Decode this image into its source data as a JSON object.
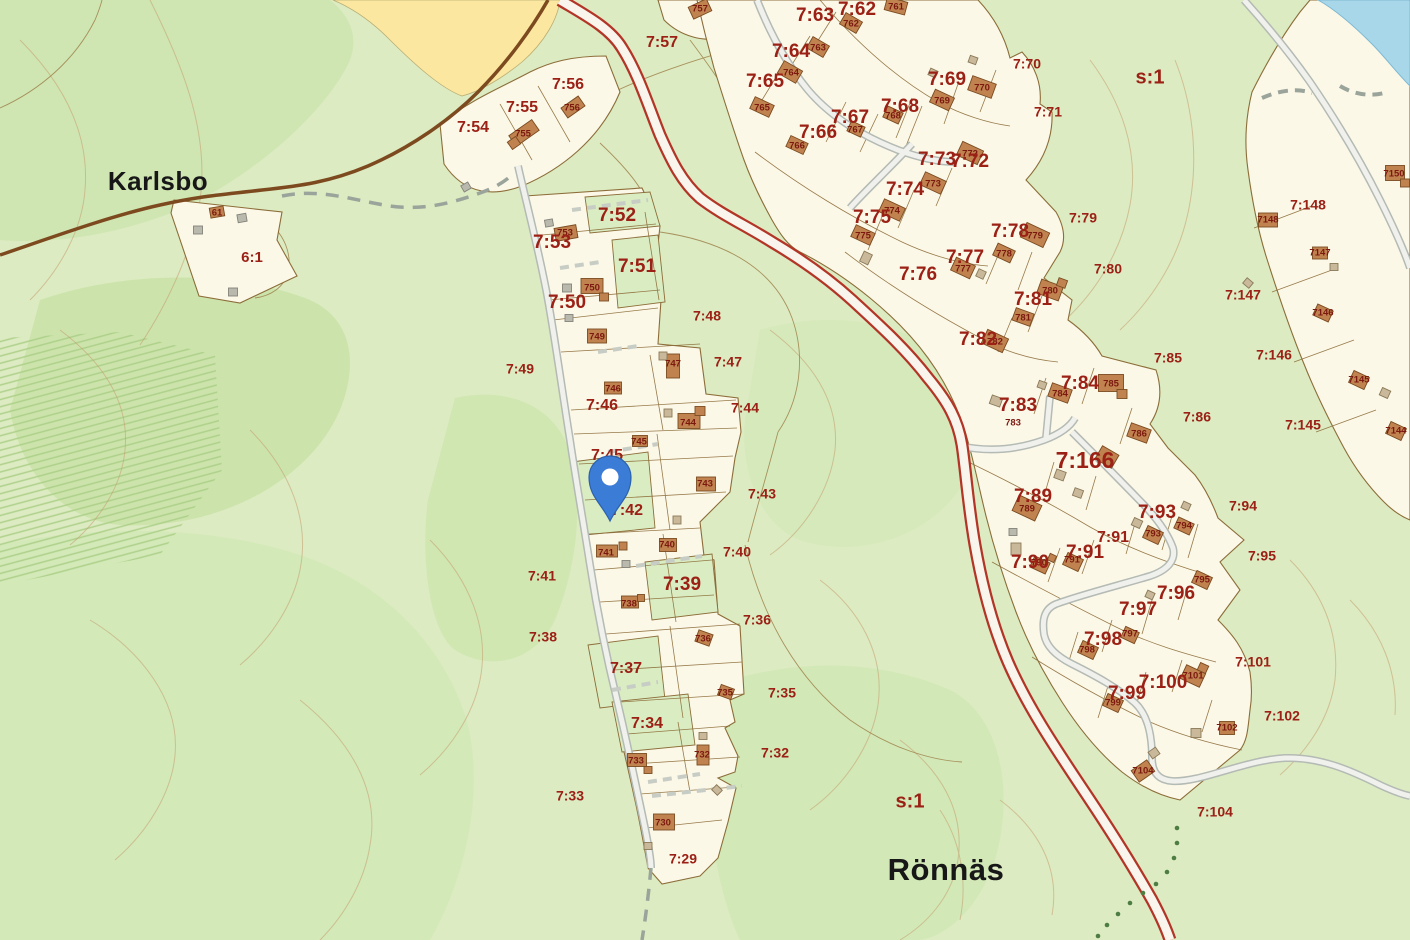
{
  "map": {
    "place_labels": [
      {
        "text": "Karlsbo",
        "x": 158,
        "y": 183,
        "size": 26
      },
      {
        "text": "Rönnäs",
        "x": 946,
        "y": 872,
        "size": 31
      }
    ],
    "area_labels": [
      {
        "text": "s:1",
        "x": 1150,
        "y": 78,
        "size": 20
      },
      {
        "text": "s:1",
        "x": 910,
        "y": 802,
        "size": 20
      },
      {
        "text": "6:1",
        "x": 252,
        "y": 258,
        "size": 15
      }
    ],
    "parcel_labels": [
      {
        "text": "7:29",
        "x": 683,
        "y": 860,
        "tier": "tier-sm"
      },
      {
        "text": "7:32",
        "x": 775,
        "y": 754,
        "tier": "tier-sm"
      },
      {
        "text": "7:33",
        "x": 570,
        "y": 797,
        "tier": "tier-sm"
      },
      {
        "text": "7:34",
        "x": 647,
        "y": 724,
        "tier": "tier-md"
      },
      {
        "text": "7:35",
        "x": 782,
        "y": 694,
        "tier": "tier-sm"
      },
      {
        "text": "7:36",
        "x": 757,
        "y": 621,
        "tier": "tier-sm"
      },
      {
        "text": "7:37",
        "x": 626,
        "y": 669,
        "tier": "tier-md"
      },
      {
        "text": "7:38",
        "x": 543,
        "y": 638,
        "tier": "tier-sm"
      },
      {
        "text": "7:39",
        "x": 682,
        "y": 585,
        "tier": "tier-lg"
      },
      {
        "text": "7:40",
        "x": 737,
        "y": 553,
        "tier": "tier-sm"
      },
      {
        "text": "7:41",
        "x": 542,
        "y": 577,
        "tier": "tier-sm"
      },
      {
        "text": "7:42",
        "x": 627,
        "y": 511,
        "tier": "tier-md"
      },
      {
        "text": "7:43",
        "x": 762,
        "y": 495,
        "tier": "tier-sm"
      },
      {
        "text": "7:44",
        "x": 745,
        "y": 409,
        "tier": "tier-sm"
      },
      {
        "text": "7:45",
        "x": 607,
        "y": 456,
        "tier": "tier-md"
      },
      {
        "text": "7:46",
        "x": 602,
        "y": 406,
        "tier": "tier-md"
      },
      {
        "text": "7:47",
        "x": 728,
        "y": 363,
        "tier": "tier-sm"
      },
      {
        "text": "7:48",
        "x": 707,
        "y": 317,
        "tier": "tier-sm"
      },
      {
        "text": "7:49",
        "x": 520,
        "y": 370,
        "tier": "tier-sm"
      },
      {
        "text": "7:50",
        "x": 567,
        "y": 303,
        "tier": "tier-lg"
      },
      {
        "text": "7:51",
        "x": 637,
        "y": 267,
        "tier": "tier-lg"
      },
      {
        "text": "7:52",
        "x": 617,
        "y": 216,
        "tier": "tier-lg"
      },
      {
        "text": "7:53",
        "x": 552,
        "y": 243,
        "tier": "tier-lg"
      },
      {
        "text": "7:54",
        "x": 473,
        "y": 128,
        "tier": "tier-md"
      },
      {
        "text": "7:55",
        "x": 522,
        "y": 108,
        "tier": "tier-md"
      },
      {
        "text": "7:56",
        "x": 568,
        "y": 85,
        "tier": "tier-md"
      },
      {
        "text": "7:57",
        "x": 662,
        "y": 43,
        "tier": "tier-md"
      },
      {
        "text": "7:62",
        "x": 857,
        "y": 10,
        "tier": "tier-lg"
      },
      {
        "text": "7:63",
        "x": 815,
        "y": 16,
        "tier": "tier-lg"
      },
      {
        "text": "7:64",
        "x": 791,
        "y": 52,
        "tier": "tier-lg"
      },
      {
        "text": "7:65",
        "x": 765,
        "y": 82,
        "tier": "tier-lg"
      },
      {
        "text": "7:66",
        "x": 818,
        "y": 133,
        "tier": "tier-lg"
      },
      {
        "text": "7:67",
        "x": 850,
        "y": 118,
        "tier": "tier-lg"
      },
      {
        "text": "7:68",
        "x": 900,
        "y": 107,
        "tier": "tier-lg"
      },
      {
        "text": "7:69",
        "x": 947,
        "y": 80,
        "tier": "tier-lg"
      },
      {
        "text": "7:70",
        "x": 1027,
        "y": 65,
        "tier": "tier-sm"
      },
      {
        "text": "7:71",
        "x": 1048,
        "y": 113,
        "tier": "tier-sm"
      },
      {
        "text": "7:72",
        "x": 970,
        "y": 162,
        "tier": "tier-lg"
      },
      {
        "text": "7:73",
        "x": 937,
        "y": 160,
        "tier": "tier-lg"
      },
      {
        "text": "7:74",
        "x": 905,
        "y": 190,
        "tier": "tier-lg"
      },
      {
        "text": "7:75",
        "x": 872,
        "y": 218,
        "tier": "tier-lg"
      },
      {
        "text": "7:76",
        "x": 918,
        "y": 275,
        "tier": "tier-lg"
      },
      {
        "text": "7:77",
        "x": 965,
        "y": 258,
        "tier": "tier-lg"
      },
      {
        "text": "7:78",
        "x": 1010,
        "y": 232,
        "tier": "tier-lg"
      },
      {
        "text": "7:79",
        "x": 1083,
        "y": 219,
        "tier": "tier-sm"
      },
      {
        "text": "7:80",
        "x": 1108,
        "y": 270,
        "tier": "tier-sm"
      },
      {
        "text": "7:81",
        "x": 1033,
        "y": 300,
        "tier": "tier-lg"
      },
      {
        "text": "7:82",
        "x": 978,
        "y": 340,
        "tier": "tier-lg"
      },
      {
        "text": "7:83",
        "x": 1018,
        "y": 406,
        "tier": "tier-lg"
      },
      {
        "text": "7:84",
        "x": 1080,
        "y": 384,
        "tier": "tier-lg"
      },
      {
        "text": "7:85",
        "x": 1168,
        "y": 359,
        "tier": "tier-sm"
      },
      {
        "text": "7:86",
        "x": 1197,
        "y": 418,
        "tier": "tier-sm"
      },
      {
        "text": "7:89",
        "x": 1033,
        "y": 497,
        "tier": "tier-lg"
      },
      {
        "text": "7:90",
        "x": 1030,
        "y": 563,
        "tier": "tier-lg"
      },
      {
        "text": "7:91",
        "x": 1113,
        "y": 538,
        "tier": "tier-md"
      },
      {
        "text": "7:91",
        "x": 1085,
        "y": 553,
        "tier": "tier-lg"
      },
      {
        "text": "7:93",
        "x": 1157,
        "y": 513,
        "tier": "tier-lg"
      },
      {
        "text": "7:94",
        "x": 1243,
        "y": 507,
        "tier": "tier-sm"
      },
      {
        "text": "7:95",
        "x": 1262,
        "y": 557,
        "tier": "tier-sm"
      },
      {
        "text": "7:96",
        "x": 1176,
        "y": 594,
        "tier": "tier-lg"
      },
      {
        "text": "7:97",
        "x": 1138,
        "y": 610,
        "tier": "tier-lg"
      },
      {
        "text": "7:98",
        "x": 1103,
        "y": 640,
        "tier": "tier-lg"
      },
      {
        "text": "7:99",
        "x": 1127,
        "y": 694,
        "tier": "tier-lg"
      },
      {
        "text": "7:100",
        "x": 1163,
        "y": 683,
        "tier": "tier-lg"
      },
      {
        "text": "7:101",
        "x": 1253,
        "y": 663,
        "tier": "tier-sm"
      },
      {
        "text": "7:102",
        "x": 1282,
        "y": 717,
        "tier": "tier-sm"
      },
      {
        "text": "7:104",
        "x": 1215,
        "y": 813,
        "tier": "tier-sm"
      },
      {
        "text": "7:145",
        "x": 1303,
        "y": 426,
        "tier": "tier-sm"
      },
      {
        "text": "7:146",
        "x": 1274,
        "y": 356,
        "tier": "tier-sm"
      },
      {
        "text": "7:147",
        "x": 1243,
        "y": 296,
        "tier": "tier-sm"
      },
      {
        "text": "7:148",
        "x": 1308,
        "y": 206,
        "tier": "tier-sm"
      },
      {
        "text": "7:166",
        "x": 1085,
        "y": 462,
        "tier": "tier-xl"
      }
    ],
    "building_labels": [
      {
        "text": "61",
        "x": 217,
        "y": 213
      },
      {
        "text": "753",
        "x": 565,
        "y": 233
      },
      {
        "text": "755",
        "x": 523,
        "y": 134
      },
      {
        "text": "756",
        "x": 572,
        "y": 108
      },
      {
        "text": "757",
        "x": 700,
        "y": 9
      },
      {
        "text": "750",
        "x": 592,
        "y": 288
      },
      {
        "text": "749",
        "x": 597,
        "y": 337
      },
      {
        "text": "747",
        "x": 673,
        "y": 364
      },
      {
        "text": "746",
        "x": 613,
        "y": 389
      },
      {
        "text": "744",
        "x": 688,
        "y": 423
      },
      {
        "text": "745",
        "x": 639,
        "y": 442
      },
      {
        "text": "743",
        "x": 705,
        "y": 484
      },
      {
        "text": "741",
        "x": 606,
        "y": 553
      },
      {
        "text": "740",
        "x": 667,
        "y": 545
      },
      {
        "text": "738",
        "x": 629,
        "y": 604
      },
      {
        "text": "736",
        "x": 703,
        "y": 639
      },
      {
        "text": "735",
        "x": 725,
        "y": 693
      },
      {
        "text": "733",
        "x": 636,
        "y": 761
      },
      {
        "text": "732",
        "x": 702,
        "y": 755
      },
      {
        "text": "730",
        "x": 663,
        "y": 823
      },
      {
        "text": "761",
        "x": 896,
        "y": 7
      },
      {
        "text": "762",
        "x": 851,
        "y": 24
      },
      {
        "text": "763",
        "x": 818,
        "y": 48
      },
      {
        "text": "764",
        "x": 791,
        "y": 73
      },
      {
        "text": "765",
        "x": 762,
        "y": 108
      },
      {
        "text": "766",
        "x": 797,
        "y": 146
      },
      {
        "text": "767",
        "x": 855,
        "y": 130
      },
      {
        "text": "768",
        "x": 893,
        "y": 116
      },
      {
        "text": "769",
        "x": 942,
        "y": 101
      },
      {
        "text": "770",
        "x": 982,
        "y": 88
      },
      {
        "text": "772",
        "x": 970,
        "y": 154
      },
      {
        "text": "773",
        "x": 933,
        "y": 184
      },
      {
        "text": "774",
        "x": 892,
        "y": 211
      },
      {
        "text": "775",
        "x": 863,
        "y": 236
      },
      {
        "text": "777",
        "x": 963,
        "y": 269
      },
      {
        "text": "778",
        "x": 1004,
        "y": 254
      },
      {
        "text": "779",
        "x": 1035,
        "y": 236
      },
      {
        "text": "780",
        "x": 1050,
        "y": 291
      },
      {
        "text": "781",
        "x": 1023,
        "y": 318
      },
      {
        "text": "782",
        "x": 995,
        "y": 342
      },
      {
        "text": "783",
        "x": 1013,
        "y": 423
      },
      {
        "text": "784",
        "x": 1060,
        "y": 394
      },
      {
        "text": "785",
        "x": 1111,
        "y": 384
      },
      {
        "text": "786",
        "x": 1139,
        "y": 434
      },
      {
        "text": "789",
        "x": 1027,
        "y": 509
      },
      {
        "text": "790",
        "x": 1039,
        "y": 563
      },
      {
        "text": "791",
        "x": 1072,
        "y": 560
      },
      {
        "text": "793",
        "x": 1153,
        "y": 534
      },
      {
        "text": "794",
        "x": 1184,
        "y": 526
      },
      {
        "text": "795",
        "x": 1202,
        "y": 580
      },
      {
        "text": "797",
        "x": 1130,
        "y": 634
      },
      {
        "text": "798",
        "x": 1087,
        "y": 650
      },
      {
        "text": "799",
        "x": 1113,
        "y": 703
      },
      {
        "text": "7101",
        "x": 1193,
        "y": 676
      },
      {
        "text": "7102",
        "x": 1227,
        "y": 728
      },
      {
        "text": "7104",
        "x": 1143,
        "y": 771
      },
      {
        "text": "7144",
        "x": 1396,
        "y": 431
      },
      {
        "text": "7145",
        "x": 1359,
        "y": 380
      },
      {
        "text": "7146",
        "x": 1323,
        "y": 313
      },
      {
        "text": "7147",
        "x": 1320,
        "y": 253
      },
      {
        "text": "7148",
        "x": 1268,
        "y": 220
      },
      {
        "text": "7150",
        "x": 1394,
        "y": 174
      }
    ],
    "marker": {
      "name": "location-pin",
      "color": "#3b7cd6"
    },
    "colors": {
      "base_green": "#dcebc1",
      "forest_green": "#cde5ae",
      "mid_green": "#d4e8b6",
      "field_yellow": "#fbe7a0",
      "parcel_cream": "#fcf8e8",
      "boundary": "#8c6d39",
      "road_brown": "#7d4a1f",
      "road_red": "#b23527",
      "road_gray": "#b4bab4",
      "contour": "#c49d6f",
      "water": "#a7d7e8",
      "building": "#c08350",
      "shed_tan": "#c9b89a",
      "shed_gray": "#b9b9ad",
      "label_red": "#9b2015",
      "pin_blue": "#3b7cd6",
      "trail_dot": "#4d7d42"
    }
  }
}
